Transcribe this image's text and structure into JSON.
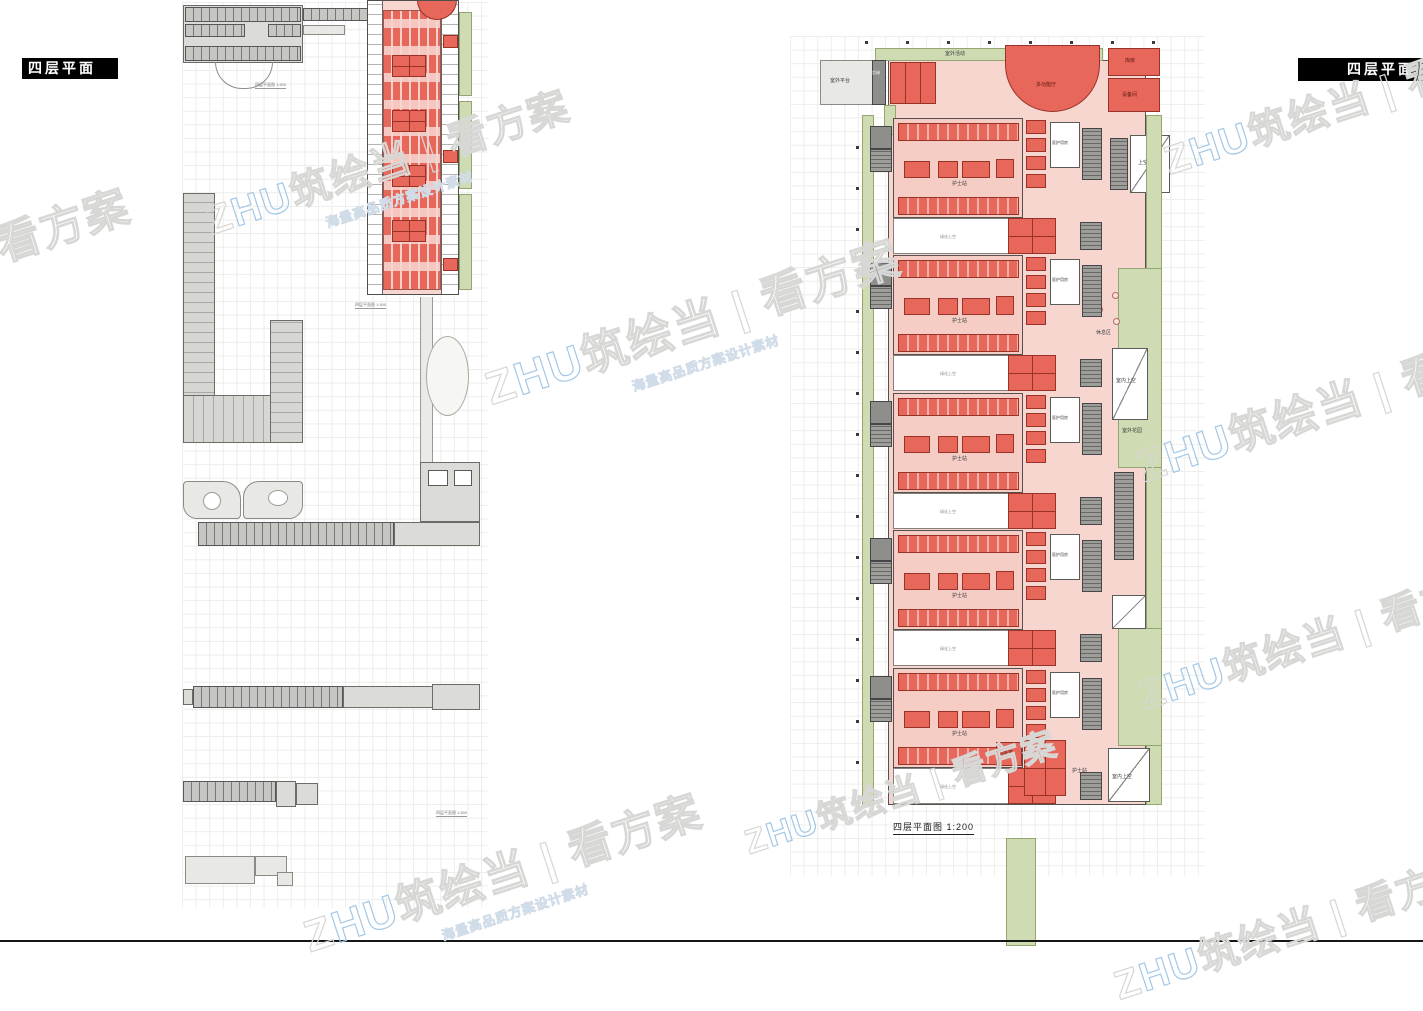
{
  "page": {
    "title_left": "四层平面",
    "title_right": "四层平面",
    "caption_main": "四层平面图 1:200",
    "caption_small": "四层平面图 1:500"
  },
  "watermark": {
    "prefix": "Z",
    "blue": "HU",
    "mid": "筑绘当",
    "divider": " | ",
    "tail": "看方案",
    "tagline": "海量高品质方案设计素材"
  },
  "colors": {
    "room_red": "#e7675b",
    "corridor_pink": "#f7d6d0",
    "landscape_green": "#cfdbb2",
    "building_gray": "#dbdbd7",
    "title_bg": "#000000"
  },
  "right_plan": {
    "labels": {
      "outdoor_activity": "室外活动",
      "outdoor_platform": "室外平台",
      "freight_elevator": "货梯",
      "hall": "多功能厅",
      "storage": "库房",
      "equipment": "设备间",
      "upper_void": "上空",
      "nurse_station": "护士站",
      "staff_room": "医护用房",
      "green_void": "绿化上空",
      "indoor_void": "室内上空",
      "outdoor_garden": "室外花园",
      "rest_area": "休息区",
      "duty_room": "值班室"
    }
  }
}
